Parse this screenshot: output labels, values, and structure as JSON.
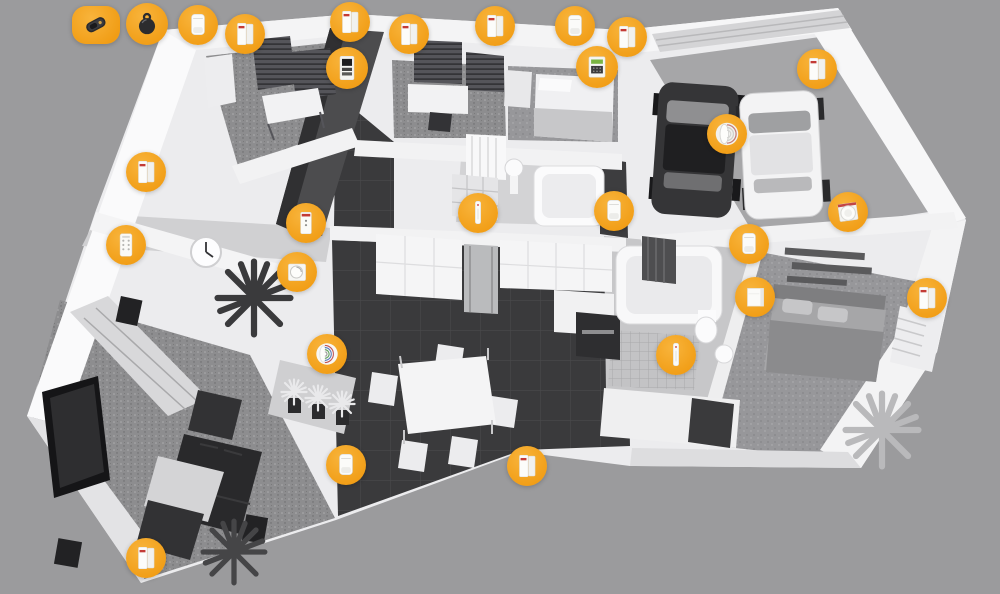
{
  "scene": {
    "description": "Isometric 3D cutaway floor plan of a house with wireless alarm system devices highlighted by orange circular markers",
    "background_color": "#9b9b9d",
    "accent_color": "#F5A11F"
  },
  "rooms": [
    {
      "name": "office-top-left"
    },
    {
      "name": "study-top-middle"
    },
    {
      "name": "single-bedroom"
    },
    {
      "name": "garage"
    },
    {
      "name": "bathroom-middle"
    },
    {
      "name": "kitchen"
    },
    {
      "name": "dining-area"
    },
    {
      "name": "bathroom-right"
    },
    {
      "name": "master-bedroom"
    },
    {
      "name": "living-room"
    },
    {
      "name": "hallway"
    }
  ],
  "devices": [
    {
      "type": "remote-control",
      "label": "Remote control key fob",
      "x": 96,
      "y": 25
    },
    {
      "type": "key-badge",
      "label": "Key ring badge tag",
      "x": 147,
      "y": 24
    },
    {
      "type": "motion-detector",
      "label": "Motion detector",
      "x": 198,
      "y": 25
    },
    {
      "type": "door-window-sensor",
      "label": "Door/window opening sensor",
      "x": 245,
      "y": 34
    },
    {
      "type": "door-window-sensor",
      "label": "Door/window opening sensor",
      "x": 350,
      "y": 22
    },
    {
      "type": "control-panel",
      "label": "Alarm control panel",
      "x": 347,
      "y": 68
    },
    {
      "type": "door-window-sensor",
      "label": "Door/window opening sensor",
      "x": 409,
      "y": 34
    },
    {
      "type": "door-window-sensor",
      "label": "Door/window opening sensor",
      "x": 495,
      "y": 26
    },
    {
      "type": "motion-detector",
      "label": "Motion detector",
      "x": 575,
      "y": 26
    },
    {
      "type": "door-window-sensor",
      "label": "Door/window opening sensor",
      "x": 627,
      "y": 37
    },
    {
      "type": "alarm-keypad",
      "label": "Alarm keypad with display",
      "x": 597,
      "y": 67
    },
    {
      "type": "door-window-sensor",
      "label": "Door/window opening sensor",
      "x": 817,
      "y": 69
    },
    {
      "type": "outdoor-siren",
      "label": "Outdoor siren",
      "x": 727,
      "y": 134
    },
    {
      "type": "door-window-sensor",
      "label": "Door/window opening sensor",
      "x": 146,
      "y": 172
    },
    {
      "type": "mini-keypad",
      "label": "Wall mini keypad",
      "x": 126,
      "y": 245
    },
    {
      "type": "wall-sensor",
      "label": "Wall sensor",
      "x": 306,
      "y": 223
    },
    {
      "type": "thermostat",
      "label": "Thermostat dial",
      "x": 297,
      "y": 272
    },
    {
      "type": "indoor-siren",
      "label": "Indoor siren",
      "x": 327,
      "y": 354
    },
    {
      "type": "slim-sensor",
      "label": "Slim detector",
      "x": 478,
      "y": 213
    },
    {
      "type": "motion-detector",
      "label": "Motion detector",
      "x": 614,
      "y": 211
    },
    {
      "type": "slim-sensor",
      "label": "Slim detector",
      "x": 676,
      "y": 355
    },
    {
      "type": "motion-detector",
      "label": "Motion detector",
      "x": 749,
      "y": 244
    },
    {
      "type": "wall-panel",
      "label": "Flat wall panel",
      "x": 755,
      "y": 297
    },
    {
      "type": "smoke-detector",
      "label": "Smoke detector",
      "x": 848,
      "y": 212
    },
    {
      "type": "door-window-sensor",
      "label": "Door/window opening sensor",
      "x": 927,
      "y": 298
    },
    {
      "type": "motion-detector",
      "label": "Motion detector",
      "x": 346,
      "y": 465
    },
    {
      "type": "door-window-sensor",
      "label": "Door/window opening sensor",
      "x": 527,
      "y": 466
    },
    {
      "type": "door-window-sensor",
      "label": "Door/window opening sensor",
      "x": 146,
      "y": 558
    }
  ]
}
